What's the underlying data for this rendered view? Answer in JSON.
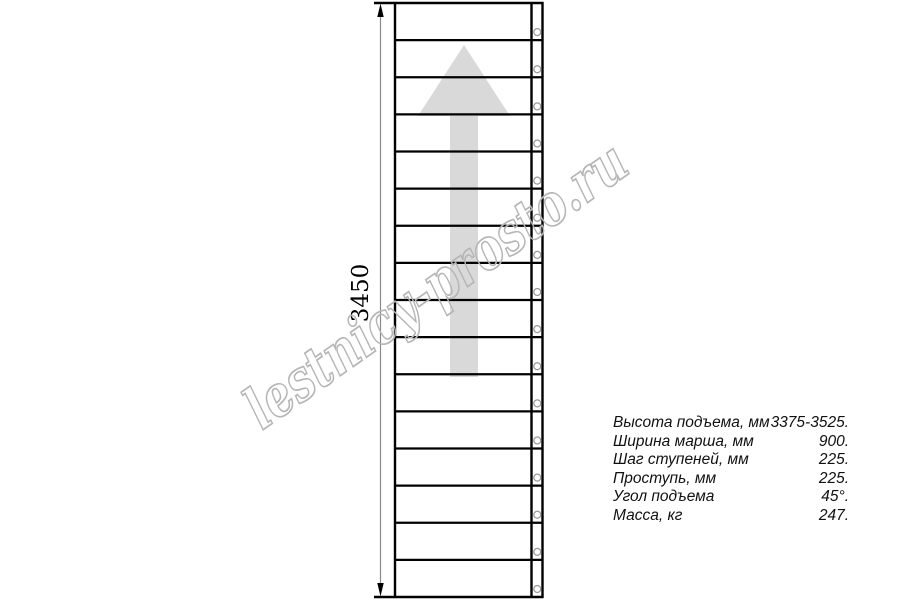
{
  "page": {
    "kind": "staircase technical drawing, plan view"
  },
  "drawing": {
    "type": "straight-staircase-plan",
    "step_count": 16,
    "direction_arrow": "up",
    "holes_per_step": 1
  },
  "dimension": {
    "label": "3450"
  },
  "watermark": {
    "text": "lestnicy-prosto.ru"
  },
  "specs": {
    "rows": [
      {
        "label": "Высота подъема, мм",
        "value": "3375-3525."
      },
      {
        "label": "Ширина марша, мм",
        "value": "900."
      },
      {
        "label": "Шаг ступеней, мм",
        "value": "225."
      },
      {
        "label": "Проступь, мм",
        "value": "225."
      },
      {
        "label": "Угол подъема",
        "value": "45°."
      },
      {
        "label": "Масса, кг",
        "value": "247."
      }
    ]
  },
  "colors": {
    "line": "#000000",
    "arrow_fill": "#d9d9d9",
    "watermark": "#b5b5b5",
    "dimension_line": "#8a8a8a",
    "hole_stroke": "#9a9a9a",
    "text": "#111111"
  }
}
